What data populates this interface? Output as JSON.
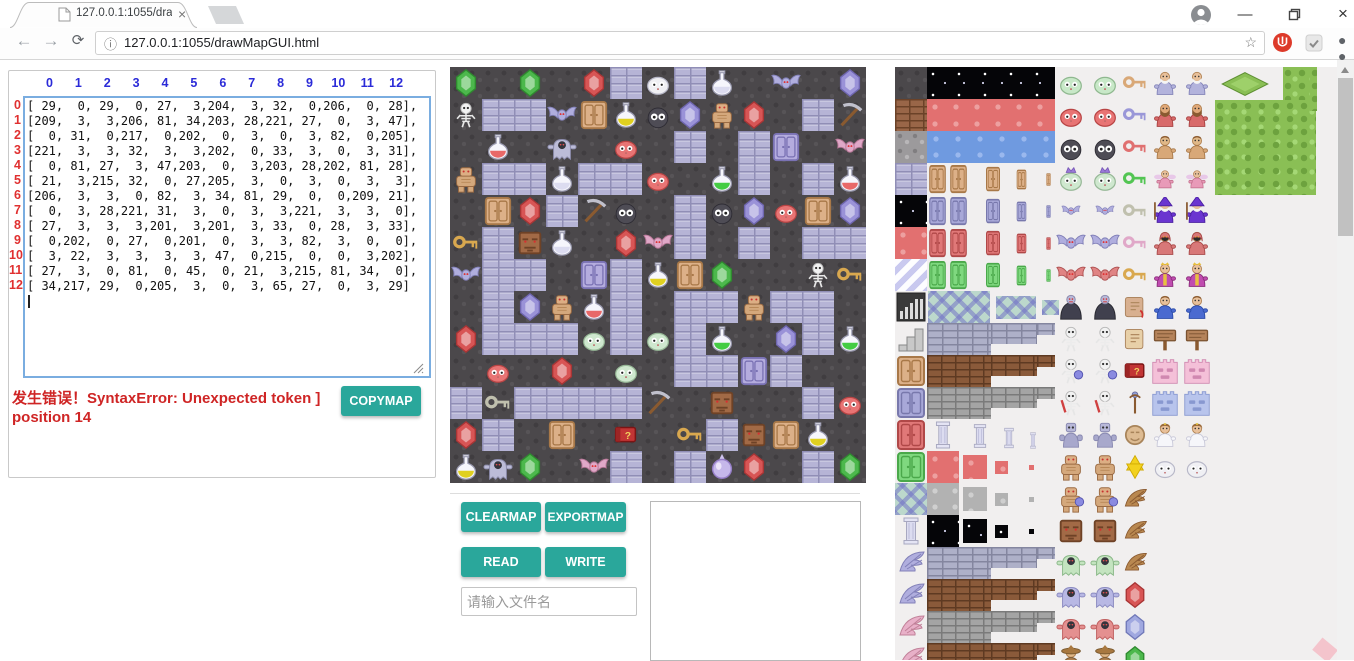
{
  "browser": {
    "tab_title": "127.0.0.1:1055/drawMa",
    "url": "127.0.0.1:1055/drawMapGUI.html",
    "icons": {
      "back": "←",
      "forward": "→",
      "refresh": "⟳",
      "info": "ⓘ",
      "bookmark_star": "☆",
      "menu": "⋮",
      "tab_close": "×",
      "minimize": "—",
      "close": "×"
    }
  },
  "editor": {
    "col_headers": [
      "0",
      "1",
      "2",
      "3",
      "4",
      "5",
      "6",
      "7",
      "8",
      "9",
      "10",
      "11",
      "12"
    ],
    "row_headers": [
      "0",
      "1",
      "2",
      "3",
      "4",
      "5",
      "6",
      "7",
      "8",
      "9",
      "10",
      "11",
      "12"
    ],
    "matrix": [
      [
        29,
        0,
        29,
        0,
        27,
        3,
        204,
        3,
        32,
        0,
        206,
        0,
        28
      ],
      [
        209,
        3,
        3,
        206,
        81,
        34,
        203,
        28,
        221,
        27,
        0,
        3,
        47
      ],
      [
        0,
        31,
        0,
        217,
        0,
        202,
        0,
        3,
        0,
        3,
        82,
        0,
        205
      ],
      [
        221,
        3,
        3,
        32,
        3,
        3,
        202,
        0,
        33,
        3,
        0,
        3,
        31
      ],
      [
        0,
        81,
        27,
        3,
        47,
        203,
        0,
        3,
        203,
        28,
        202,
        81,
        28
      ],
      [
        21,
        3,
        215,
        32,
        0,
        27,
        205,
        3,
        0,
        3,
        0,
        3,
        3
      ],
      [
        206,
        3,
        3,
        0,
        82,
        3,
        34,
        81,
        29,
        0,
        0,
        209,
        21
      ],
      [
        0,
        3,
        28,
        221,
        31,
        3,
        0,
        3,
        3,
        221,
        3,
        3,
        0
      ],
      [
        27,
        3,
        3,
        3,
        201,
        3,
        201,
        3,
        33,
        0,
        28,
        3,
        33
      ],
      [
        0,
        202,
        0,
        27,
        0,
        201,
        0,
        3,
        3,
        82,
        3,
        0,
        0
      ],
      [
        3,
        22,
        3,
        3,
        3,
        3,
        47,
        0,
        215,
        0,
        0,
        3,
        202
      ],
      [
        27,
        3,
        0,
        81,
        0,
        45,
        0,
        21,
        3,
        215,
        81,
        34,
        0
      ],
      [
        34,
        217,
        29,
        0,
        205,
        3,
        0,
        3,
        65,
        27,
        0,
        3,
        29
      ]
    ],
    "error_line1": "发生错误！SyntaxError: Unexpected token ]",
    "error_line2": "position 14",
    "copymap_label": "COPYMAP"
  },
  "controls": {
    "clearmap": "CLEARMAP",
    "exportmap": "EXPORTMAP",
    "read": "READ",
    "write": "WRITE",
    "file_placeholder": "请输入文件名"
  },
  "map": {
    "tile_size": 32,
    "legend": {
      "0": "floor",
      "3": "wall",
      "21": "key-gold",
      "22": "key-silver",
      "27": "gem-red",
      "28": "gem-purple",
      "29": "gem-green",
      "31": "flask-red",
      "32": "flask-white",
      "33": "flask-green",
      "34": "flask-yellow",
      "45": "book",
      "47": "pickaxe",
      "65": "orb",
      "81": "door-tan",
      "82": "door-purple",
      "201": "slime-pale",
      "202": "slime-red",
      "203": "eyeball",
      "204": "slime-white",
      "205": "bat-pink",
      "206": "bat-purple",
      "209": "skeleton",
      "215": "face",
      "217": "ghost",
      "221": "golem"
    }
  },
  "tileset": {
    "colA": [
      "floor",
      "brickbrown",
      "stonegray",
      "wall",
      "starfield",
      "redpat",
      "stripes",
      "bars",
      "stairs",
      "door-tan",
      "door-blue",
      "door-red",
      "door-green",
      "lattice",
      "pillar",
      "wing-blue",
      "wing-blue",
      "wing-pink",
      "wing-pink"
    ],
    "groupB": [
      "block-star",
      "block-red",
      "block-blue",
      "doorq-tan",
      "doorq-blue",
      "doorq-red",
      "doorq-green",
      "latticeq",
      "steps-stone",
      "steps-brown",
      "steps-gray",
      "pillars",
      "swq-red",
      "swq-gray",
      "swq-black",
      "steps-stone",
      "steps-brown",
      "steps-gray",
      "steps-brown"
    ],
    "monsters": [
      "slime-green",
      "slime-red",
      "eyeball",
      "slime-crown",
      "bat-small",
      "bat-purple",
      "bat-red",
      "vampire",
      "skeleton",
      "skeleton-shield",
      "skeleton-sword",
      "robot",
      "mummy",
      "mummy-shield",
      "face",
      "ghost-green",
      "ghost-purple",
      "ghost-red",
      "hatman"
    ],
    "items": [
      "key-tan",
      "key-blue",
      "key-red",
      "key-green",
      "key-silver",
      "key-pink",
      "key-gold",
      "scroll-red",
      "scroll-tan",
      "book",
      "staff",
      "medallion",
      "star",
      "wing-brown",
      "wing-brown",
      "wing-brown",
      "gem-red",
      "gem-blue",
      "gem-green"
    ],
    "chars": [
      "elder",
      "dwarf",
      "fighter",
      "fairy",
      "wizard",
      "reaper",
      "royal",
      "boy",
      "sign",
      "wall-pink",
      "wall-blue",
      "princess",
      "slime-white",
      "",
      "",
      "",
      "",
      "",
      ""
    ]
  },
  "colors": {
    "accent": "#2aa79b",
    "error_red": "#cf2525",
    "col_header_blue": "#2b2bd8",
    "row_header_red": "#e03030",
    "tileset_bg": "#f1efef"
  }
}
